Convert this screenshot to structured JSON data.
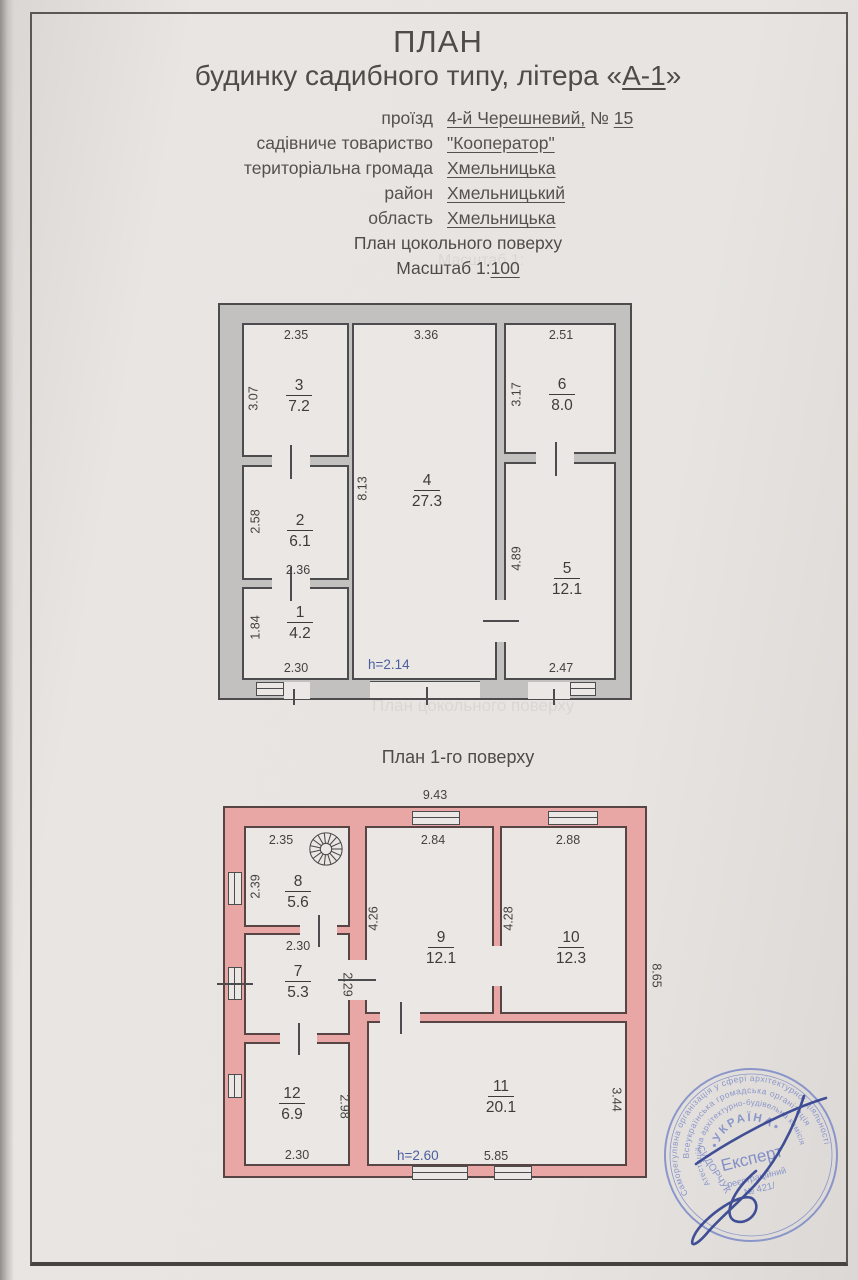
{
  "header": {
    "title_line1": "ПЛАН",
    "title_line2_prefix": "будинку садибного типу, літера «",
    "title_line2_littera": "А-1",
    "title_line2_suffix": "»",
    "fields": [
      {
        "label": "проїзд",
        "value": "4-й Черешневий,",
        "sep": " № ",
        "value2": "15"
      },
      {
        "label": "садівниче товариство",
        "value": "\"Кооператор\""
      },
      {
        "label": "територіальна громада",
        "value": "Хмельницька"
      },
      {
        "label": "район",
        "value": "Хмельницький"
      },
      {
        "label": "область",
        "value": "Хмельницька"
      }
    ]
  },
  "basement": {
    "section_title": "План цокольного поверху",
    "scale_prefix": "Масштаб 1:",
    "scale_value": "100",
    "height_note": "h=2.14",
    "rooms": [
      {
        "num": "1",
        "area": "4.2",
        "width": "2.30",
        "height": "1.84"
      },
      {
        "num": "2",
        "area": "6.1",
        "width": "2.36",
        "height": "2.58"
      },
      {
        "num": "3",
        "area": "7.2",
        "width": "2.35",
        "height": "3.07"
      },
      {
        "num": "4",
        "area": "27.3",
        "width": "3.36",
        "height": "8.13"
      },
      {
        "num": "5",
        "area": "12.1",
        "width": "2.47",
        "height": "4.89"
      },
      {
        "num": "6",
        "area": "8.0",
        "width": "2.51",
        "height": "3.17"
      }
    ]
  },
  "first_floor": {
    "section_title": "План 1-го поверху",
    "overall_width": "9.43",
    "overall_height": "8.65",
    "height_note": "h=2.60",
    "rooms": [
      {
        "num": "7",
        "area": "5.3",
        "width": "2.30",
        "height": "2.29"
      },
      {
        "num": "8",
        "area": "5.6",
        "width": "2.35",
        "height": "2.39"
      },
      {
        "num": "9",
        "area": "12.1",
        "width": "2.84",
        "height": "4.26"
      },
      {
        "num": "10",
        "area": "12.3",
        "width": "2.88",
        "height": "4.28"
      },
      {
        "num": "11",
        "area": "20.1",
        "width": "5.85",
        "height": "3.44"
      },
      {
        "num": "12",
        "area": "6.9",
        "width": "2.30",
        "height": "2.98"
      }
    ]
  },
  "stamp": {
    "ring_outer": "Саморегулівна організація у сфері архітектурної діяльності",
    "ring_middle": "Всеукраїнська громадська організація",
    "ring_inner": "Атестаційна архітектурно-будівельна комісія",
    "country": "•УКРАЇНА•",
    "center_title": "Експерт",
    "center_line2": "реєстраційний",
    "center_line3": "№ 421/",
    "name": "СИДОРЧУК"
  },
  "colors": {
    "basement_wall": "#c2c1bf",
    "floor_wall": "#e8a7a4",
    "note_blue": "#4a5f9e",
    "stamp_blue": "#7585c7"
  }
}
